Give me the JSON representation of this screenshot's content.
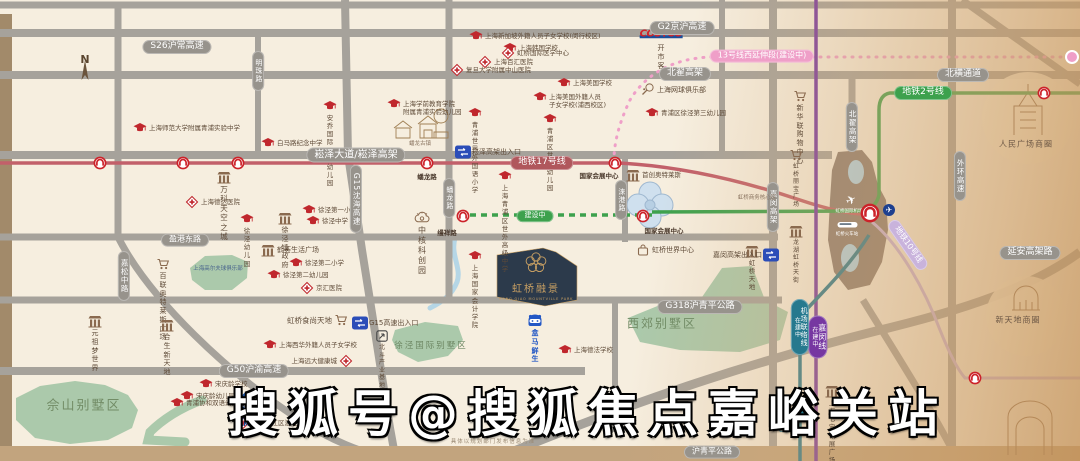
{
  "project": {
    "name": "虹桥融景",
    "caption": "HONG QIAO MOUNTVILLE PARK",
    "emblem": "plum-blossom-icon"
  },
  "watermark": "搜狐号@搜狐焦点嘉峪关站",
  "disclaimer": "具体以规划部门发布信息为准",
  "compass": {
    "label": "N"
  },
  "colors": {
    "background": "#f6eedf",
    "road": "#a6a29b",
    "roadPill": "#97938c",
    "metro2": "#3da14d",
    "metro17": "#c2606a",
    "metro17Pill": "#b0575c",
    "metro13": "#ef9fc8",
    "metro10": "#c9b3dc",
    "jiamin": "#7637a1",
    "airportLink": "#26798e",
    "green": "#abc9ab",
    "water": "#b5d6e6",
    "hub": "#8b7c71",
    "brand": "#2c3a4b",
    "gold": "#c9a063",
    "schoolRed": "#c0272d",
    "poiBrown": "#8a6a4f",
    "blue": "#2257c5",
    "exitBlue": "#2b4db8",
    "roundelRed": "#cc2229"
  },
  "map": {
    "road_pills": [
      {
        "label": "S26沪常高速",
        "x": 177,
        "y": 47,
        "kind": "road"
      },
      {
        "label": "G2京沪高速",
        "x": 682,
        "y": 28,
        "kind": "road"
      },
      {
        "label": "北翟高架",
        "x": 685,
        "y": 74,
        "kind": "road"
      },
      {
        "label": "北横通道",
        "x": 963,
        "y": 75,
        "kind": "road"
      },
      {
        "label": "崧泽大道/崧泽高架",
        "x": 356,
        "y": 155,
        "kind": "road",
        "size": 10
      },
      {
        "label": "盈港东路",
        "x": 185,
        "y": 240,
        "kind": "road",
        "size": 8
      },
      {
        "label": "G318沪青平公路",
        "x": 700,
        "y": 307,
        "kind": "road"
      },
      {
        "label": "G50沪渝高速",
        "x": 254,
        "y": 371,
        "kind": "road"
      },
      {
        "label": "延安高架路",
        "x": 1030,
        "y": 253,
        "kind": "road"
      },
      {
        "label": "沪青平公路",
        "x": 712,
        "y": 452,
        "kind": "road",
        "size": 8
      },
      {
        "label": "明珠路",
        "x": 258,
        "y": 71,
        "kind": "road",
        "v": true,
        "size": 7
      },
      {
        "label": "G15沈海高速",
        "x": 356,
        "y": 199,
        "kind": "road",
        "v": true,
        "size": 7.5
      },
      {
        "label": "嘉松中路",
        "x": 124,
        "y": 276,
        "kind": "road",
        "v": true,
        "size": 7.5
      },
      {
        "label": "蟠龙路",
        "x": 449,
        "y": 198,
        "kind": "road",
        "v": true,
        "size": 7
      },
      {
        "label": "涞港路",
        "x": 621,
        "y": 200,
        "kind": "road",
        "v": true,
        "size": 7
      },
      {
        "label": "嘉闵高架",
        "x": 773,
        "y": 207,
        "kind": "road",
        "v": true,
        "size": 7.5
      },
      {
        "label": "北翟高架",
        "x": 852,
        "y": 127,
        "kind": "road",
        "v": true,
        "size": 7.5
      },
      {
        "label": "外环高速",
        "x": 960,
        "y": 176,
        "kind": "road",
        "v": true,
        "size": 7.5
      },
      {
        "label": "地铁17号线",
        "x": 542,
        "y": 163,
        "kind": "metro17"
      },
      {
        "label": "地铁2号线",
        "x": 923,
        "y": 93,
        "kind": "metro2"
      },
      {
        "label": "13号线西延伸段(建设中)",
        "x": 762,
        "y": 56,
        "kind": "metro13",
        "size": 8
      },
      {
        "label": "建设中",
        "x": 535,
        "y": 216,
        "kind": "construction",
        "size": 7
      },
      {
        "label": "地铁10号线",
        "x": 908,
        "y": 245,
        "kind": "metro10",
        "rotate": 55,
        "size": 8
      },
      {
        "label": "嘉闵线",
        "sub": "在建中",
        "x": 818,
        "y": 337,
        "kind": "jiamin",
        "v": true,
        "size": 8
      },
      {
        "label": "机场联络线",
        "sub": "在建中",
        "x": 800,
        "y": 327,
        "kind": "airportlink",
        "v": true,
        "size": 7
      }
    ],
    "station_labels": [
      {
        "text": "蟠龙路",
        "x": 427,
        "y": 171
      },
      {
        "text": "国家会展中心",
        "x": 599,
        "y": 170
      },
      {
        "text": "缦祥路",
        "x": 447,
        "y": 227
      },
      {
        "text": "国家会展中心",
        "x": 664,
        "y": 225
      },
      {
        "text": "七宝站",
        "x": 787,
        "y": 423,
        "color": "#26798e"
      }
    ],
    "stations": [
      {
        "x": 100,
        "y": 163,
        "type": "roundel"
      },
      {
        "x": 183,
        "y": 163,
        "type": "roundel"
      },
      {
        "x": 238,
        "y": 163,
        "type": "roundel"
      },
      {
        "x": 427,
        "y": 163,
        "type": "roundel"
      },
      {
        "x": 615,
        "y": 163,
        "type": "roundel"
      },
      {
        "x": 463,
        "y": 216,
        "type": "roundel"
      },
      {
        "x": 643,
        "y": 216,
        "type": "roundel"
      },
      {
        "x": 1044,
        "y": 93,
        "type": "roundel"
      },
      {
        "x": 975,
        "y": 378,
        "type": "roundel"
      },
      {
        "x": 870,
        "y": 213,
        "type": "roundel-big"
      },
      {
        "x": 1072,
        "y": 57,
        "type": "pink-dot"
      },
      {
        "x": 800,
        "y": 411,
        "type": "teal-dot"
      }
    ],
    "area_labels": [
      {
        "text": "佘山别墅区",
        "x": 84,
        "y": 404,
        "size": 13,
        "color": "#728c66",
        "ls": 2
      },
      {
        "text": "徐泾国际别墅区",
        "x": 431,
        "y": 345,
        "size": 8.5,
        "color": "#6d8763",
        "ls": 2
      },
      {
        "text": "西郊别墅区",
        "x": 662,
        "y": 323,
        "size": 12,
        "color": "#728c66",
        "ls": 2
      },
      {
        "text": "上海高尔夫球俱乐部",
        "x": 218,
        "y": 268,
        "size": 5.5,
        "color": "#46618c",
        "ls": 0
      },
      {
        "text": "虹桥商务核心区",
        "x": 757,
        "y": 197,
        "size": 5.5,
        "color": "#8a7460",
        "ls": 0
      },
      {
        "text": "人民广场商圈",
        "x": 1026,
        "y": 144,
        "size": 8,
        "color": "#6b5644",
        "ls": 1
      },
      {
        "text": "新天地商圈",
        "x": 1018,
        "y": 320,
        "size": 8,
        "color": "#6b5644",
        "ls": 1
      },
      {
        "text": "蟠龙古镇",
        "x": 420,
        "y": 143,
        "size": 5.5,
        "color": "#8a7460",
        "ls": 0
      },
      {
        "text": "虹桥国际机场",
        "x": 849,
        "y": 211,
        "size": 4.5,
        "color": "#ffffff",
        "ls": 0
      },
      {
        "text": "虹桥火车站",
        "x": 847,
        "y": 234,
        "size": 4.5,
        "color": "#ffffff",
        "ls": 0
      }
    ],
    "pois": [
      {
        "icon": "north-compass",
        "x": 85,
        "y": 72,
        "label": "",
        "pos": "below"
      },
      {
        "icon": "school",
        "x": 140,
        "y": 128,
        "label": "上海师范大学附属青浦实验中学",
        "pos": "right"
      },
      {
        "icon": "school",
        "x": 330,
        "y": 106,
        "label": "安乔国际双语幼儿园",
        "pos": "below"
      },
      {
        "icon": "school",
        "x": 268,
        "y": 143,
        "label": "白马路纪念中学",
        "pos": "right"
      },
      {
        "icon": "school",
        "x": 476,
        "y": 36,
        "label": "上海新加坡外籍人员子女学校(闵行校区)",
        "pos": "right"
      },
      {
        "icon": "school",
        "x": 510,
        "y": 48,
        "label": "上海韩国学校",
        "pos": "right"
      },
      {
        "icon": "school",
        "x": 564,
        "y": 83,
        "label": "上海美国学校",
        "pos": "right"
      },
      {
        "icon": "school",
        "x": 540,
        "y": 97,
        "label": "上海美国外籍人员\n子女学校(浦西校区)",
        "pos": "right"
      },
      {
        "icon": "school",
        "x": 475,
        "y": 113,
        "label": "青浦世界外国语小学",
        "pos": "below"
      },
      {
        "icon": "school",
        "x": 550,
        "y": 119,
        "label": "青浦区世外幼儿园",
        "pos": "below"
      },
      {
        "icon": "school",
        "x": 652,
        "y": 113,
        "label": "青浦区徐泾第三幼儿园",
        "pos": "right"
      },
      {
        "icon": "school",
        "x": 394,
        "y": 104,
        "label": "上海学前教育学院\n附属青浦实验幼儿园",
        "pos": "right"
      },
      {
        "icon": "school",
        "x": 309,
        "y": 210,
        "label": "徐泾第一小学",
        "pos": "right"
      },
      {
        "icon": "school",
        "x": 313,
        "y": 221,
        "label": "徐泾中学",
        "pos": "right"
      },
      {
        "icon": "school",
        "x": 247,
        "y": 219,
        "label": "徐泾幼儿园",
        "pos": "below"
      },
      {
        "icon": "school",
        "x": 296,
        "y": 263,
        "label": "徐泾第二小学",
        "pos": "right"
      },
      {
        "icon": "school",
        "x": 274,
        "y": 275,
        "label": "徐泾第二幼儿园",
        "pos": "right"
      },
      {
        "icon": "school",
        "x": 505,
        "y": 176,
        "label": "上海青浦区\n世外高级中学",
        "pos": "below"
      },
      {
        "icon": "school",
        "x": 475,
        "y": 256,
        "label": "上海国家会计学院",
        "pos": "below"
      },
      {
        "icon": "school",
        "x": 270,
        "y": 345,
        "label": "上海西华外籍人员子女学校",
        "pos": "right"
      },
      {
        "icon": "school",
        "x": 206,
        "y": 384,
        "label": "宋庆龄学校",
        "pos": "right"
      },
      {
        "icon": "school",
        "x": 187,
        "y": 396,
        "label": "宋庆龄幼儿园",
        "pos": "right"
      },
      {
        "icon": "school",
        "x": 177,
        "y": 403,
        "label": "青浦协和双语幼儿园",
        "pos": "right"
      },
      {
        "icon": "school",
        "x": 565,
        "y": 350,
        "label": "上海德法学校",
        "pos": "right"
      },
      {
        "icon": "hospital",
        "x": 508,
        "y": 53,
        "label": "虹桥国际医学中心",
        "pos": "right"
      },
      {
        "icon": "hospital",
        "x": 485,
        "y": 62,
        "label": "上海百汇医院",
        "pos": "right"
      },
      {
        "icon": "hospital",
        "x": 457,
        "y": 70,
        "label": "复旦大学附属中山医院",
        "pos": "right"
      },
      {
        "icon": "hospital",
        "x": 192,
        "y": 202,
        "label": "上海德达医院",
        "pos": "right"
      },
      {
        "icon": "hospital",
        "x": 307,
        "y": 288,
        "label": "京汇医院",
        "pos": "right"
      },
      {
        "icon": "hospital",
        "x": 346,
        "y": 361,
        "label": "上海远大健康城",
        "pos": "left"
      },
      {
        "icon": "hospital",
        "x": 243,
        "y": 423,
        "label": "上海松江区泗泾医院",
        "pos": "right"
      },
      {
        "icon": "cart",
        "x": 800,
        "y": 96,
        "label": "新华联\n购物中心",
        "pos": "below",
        "size": 7
      },
      {
        "icon": "cart",
        "x": 341,
        "y": 320,
        "label": "虹桥食尚天地",
        "pos": "left",
        "size": 7.5
      },
      {
        "icon": "cart",
        "x": 163,
        "y": 264,
        "label": "百联\n奥特莱斯广场",
        "pos": "below",
        "size": 7
      },
      {
        "icon": "cart",
        "x": 796,
        "y": 155,
        "label": "虹桥丽宝广场",
        "pos": "below",
        "size": 6
      },
      {
        "icon": "building",
        "x": 224,
        "y": 177,
        "label": "万科天空之城",
        "pos": "below",
        "size": 7.5
      },
      {
        "icon": "building",
        "x": 285,
        "y": 218,
        "label": "徐泾镇政府",
        "pos": "below",
        "size": 7
      },
      {
        "icon": "building",
        "x": 268,
        "y": 250,
        "label": "鹤荟生活广场",
        "pos": "right",
        "size": 7
      },
      {
        "icon": "building",
        "x": 95,
        "y": 321,
        "label": "元祖梦世界",
        "pos": "below",
        "size": 7
      },
      {
        "icon": "building",
        "x": 167,
        "y": 325,
        "label": "合生新天地",
        "pos": "below",
        "size": 7
      },
      {
        "icon": "building",
        "x": 796,
        "y": 231,
        "label": "龙湖虹桥天街",
        "pos": "below",
        "size": 6
      },
      {
        "icon": "building",
        "x": 752,
        "y": 251,
        "label": "虹桥天地",
        "pos": "below",
        "size": 6.5
      },
      {
        "icon": "building",
        "x": 832,
        "y": 391,
        "label": "上海七宝\n领展广场",
        "pos": "below",
        "size": 6.5
      },
      {
        "icon": "building",
        "x": 633,
        "y": 175,
        "label": "首创奥特莱斯",
        "pos": "right",
        "size": 6.5
      },
      {
        "icon": "bag",
        "x": 643,
        "y": 250,
        "label": "虹桥世界中心",
        "pos": "right",
        "size": 7
      },
      {
        "icon": "tennis",
        "x": 648,
        "y": 90,
        "label": "上海网球俱乐部",
        "pos": "right",
        "size": 7
      },
      {
        "icon": "innovation",
        "x": 422,
        "y": 218,
        "label": "中核科创园",
        "pos": "below",
        "size": 8
      },
      {
        "icon": "beidou",
        "x": 382,
        "y": 336,
        "label": "北斗产业基地",
        "pos": "below",
        "size": 6
      },
      {
        "icon": "exit",
        "x": 463,
        "y": 152,
        "label": "崧泽高架出入口",
        "pos": "right",
        "size": 7
      },
      {
        "icon": "exit",
        "x": 360,
        "y": 323,
        "label": "G15高速出入口",
        "pos": "right",
        "size": 7
      },
      {
        "icon": "exit",
        "x": 771,
        "y": 255,
        "label": "嘉闵高架出入口",
        "pos": "left",
        "size": 7
      },
      {
        "icon": "costco",
        "x": 661,
        "y": 36,
        "label": "开市客",
        "pos": "below",
        "size": 7
      },
      {
        "icon": "hema",
        "x": 535,
        "y": 321,
        "label": "盒马鲜生",
        "pos": "below",
        "size": 7,
        "color": "#2257c5",
        "bold": true
      },
      {
        "icon": "sams",
        "x": 245,
        "y": 398,
        "label": "山姆会员商店\nSAM'S CLUB",
        "pos": "below",
        "size": 6,
        "color": "#1b4e9b",
        "bold": true
      },
      {
        "icon": "plane-circle",
        "x": 889,
        "y": 210,
        "label": "",
        "pos": "right"
      },
      {
        "icon": "plane-white",
        "x": 851,
        "y": 200,
        "label": "",
        "pos": "right"
      },
      {
        "icon": "train-white",
        "x": 848,
        "y": 225,
        "label": "",
        "pos": "right"
      }
    ]
  }
}
